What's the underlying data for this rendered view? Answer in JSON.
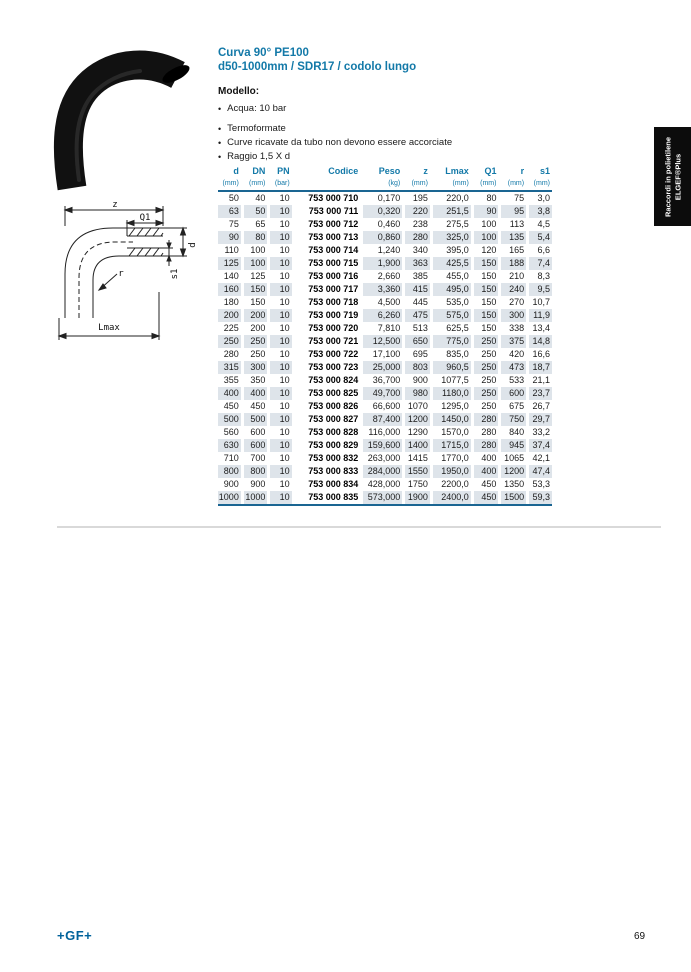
{
  "page": {
    "title_line1": "Curva 90° PE100",
    "title_line2": "d50-1000mm / SDR17 / codolo lungo",
    "footer_logo": "+GF+",
    "page_number": "69"
  },
  "sidebar": {
    "line1": "Raccordi in polietilene",
    "line2": "ELGEF®Plus"
  },
  "modello": {
    "heading": "Modello:",
    "bullets": [
      "Acqua: 10 bar",
      "Termoformate",
      "Curve ricavate da tubo non devono essere accorciate",
      "Raggio 1,5 X d"
    ]
  },
  "diagram": {
    "z": "z",
    "q1": "Q1",
    "d": "d",
    "s1": "s1",
    "r": "r",
    "lmax": "Lmax"
  },
  "table": {
    "columns": [
      {
        "label": "d",
        "unit": "(mm)"
      },
      {
        "label": "DN",
        "unit": "(mm)"
      },
      {
        "label": "PN",
        "unit": "(bar)"
      },
      {
        "label": "Codice",
        "unit": ""
      },
      {
        "label": "Peso",
        "unit": "(kg)"
      },
      {
        "label": "z",
        "unit": "(mm)"
      },
      {
        "label": "Lmax",
        "unit": "(mm)"
      },
      {
        "label": "Q1",
        "unit": "(mm)"
      },
      {
        "label": "r",
        "unit": "(mm)"
      },
      {
        "label": "s1",
        "unit": "(mm)"
      }
    ],
    "rows": [
      [
        "50",
        "40",
        "10",
        "753 000 710",
        "0,170",
        "195",
        "220,0",
        "80",
        "75",
        "3,0"
      ],
      [
        "63",
        "50",
        "10",
        "753 000 711",
        "0,320",
        "220",
        "251,5",
        "90",
        "95",
        "3,8"
      ],
      [
        "75",
        "65",
        "10",
        "753 000 712",
        "0,460",
        "238",
        "275,5",
        "100",
        "113",
        "4,5"
      ],
      [
        "90",
        "80",
        "10",
        "753 000 713",
        "0,860",
        "280",
        "325,0",
        "100",
        "135",
        "5,4"
      ],
      [
        "110",
        "100",
        "10",
        "753 000 714",
        "1,240",
        "340",
        "395,0",
        "120",
        "165",
        "6,6"
      ],
      [
        "125",
        "100",
        "10",
        "753 000 715",
        "1,900",
        "363",
        "425,5",
        "150",
        "188",
        "7,4"
      ],
      [
        "140",
        "125",
        "10",
        "753 000 716",
        "2,660",
        "385",
        "455,0",
        "150",
        "210",
        "8,3"
      ],
      [
        "160",
        "150",
        "10",
        "753 000 717",
        "3,360",
        "415",
        "495,0",
        "150",
        "240",
        "9,5"
      ],
      [
        "180",
        "150",
        "10",
        "753 000 718",
        "4,500",
        "445",
        "535,0",
        "150",
        "270",
        "10,7"
      ],
      [
        "200",
        "200",
        "10",
        "753 000 719",
        "6,260",
        "475",
        "575,0",
        "150",
        "300",
        "11,9"
      ],
      [
        "225",
        "200",
        "10",
        "753 000 720",
        "7,810",
        "513",
        "625,5",
        "150",
        "338",
        "13,4"
      ],
      [
        "250",
        "250",
        "10",
        "753 000 721",
        "12,500",
        "650",
        "775,0",
        "250",
        "375",
        "14,8"
      ],
      [
        "280",
        "250",
        "10",
        "753 000 722",
        "17,100",
        "695",
        "835,0",
        "250",
        "420",
        "16,6"
      ],
      [
        "315",
        "300",
        "10",
        "753 000 723",
        "25,000",
        "803",
        "960,5",
        "250",
        "473",
        "18,7"
      ],
      [
        "355",
        "350",
        "10",
        "753 000 824",
        "36,700",
        "900",
        "1077,5",
        "250",
        "533",
        "21,1"
      ],
      [
        "400",
        "400",
        "10",
        "753 000 825",
        "49,700",
        "980",
        "1180,0",
        "250",
        "600",
        "23,7"
      ],
      [
        "450",
        "450",
        "10",
        "753 000 826",
        "66,600",
        "1070",
        "1295,0",
        "250",
        "675",
        "26,7"
      ],
      [
        "500",
        "500",
        "10",
        "753 000 827",
        "87,400",
        "1200",
        "1450,0",
        "280",
        "750",
        "29,7"
      ],
      [
        "560",
        "600",
        "10",
        "753 000 828",
        "116,000",
        "1290",
        "1570,0",
        "280",
        "840",
        "33,2"
      ],
      [
        "630",
        "600",
        "10",
        "753 000 829",
        "159,600",
        "1400",
        "1715,0",
        "280",
        "945",
        "37,4"
      ],
      [
        "710",
        "700",
        "10",
        "753 000 832",
        "263,000",
        "1415",
        "1770,0",
        "400",
        "1065",
        "42,1"
      ],
      [
        "800",
        "800",
        "10",
        "753 000 833",
        "284,000",
        "1550",
        "1950,0",
        "400",
        "1200",
        "47,4"
      ],
      [
        "900",
        "900",
        "10",
        "753 000 834",
        "428,000",
        "1750",
        "2200,0",
        "450",
        "1350",
        "53,3"
      ],
      [
        "1000",
        "1000",
        "10",
        "753 000 835",
        "573,000",
        "1900",
        "2400,0",
        "450",
        "1500",
        "59,3"
      ]
    ]
  },
  "colors": {
    "accent": "#1379a8",
    "table_rule": "#1a6592",
    "stripe": "#dee4ea",
    "tab_bg": "#0c0c0c",
    "logo_blue": "#00629b"
  }
}
